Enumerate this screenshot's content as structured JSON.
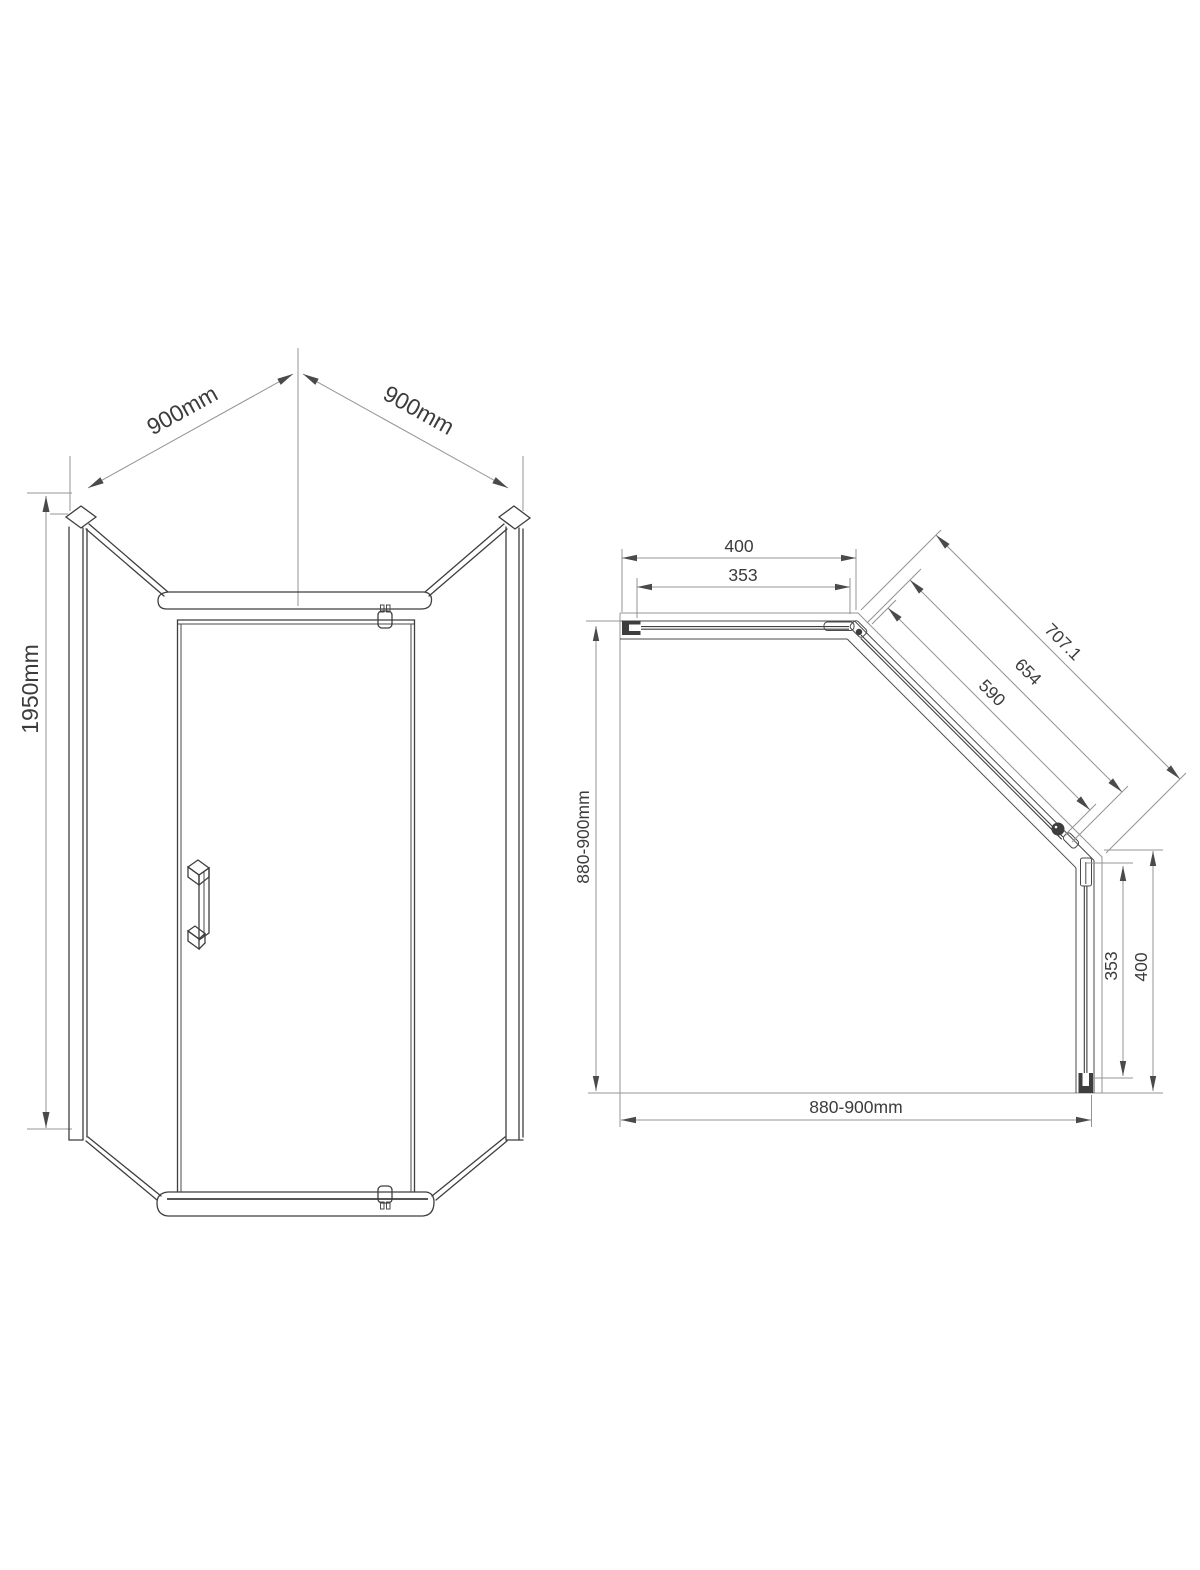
{
  "title": "Pentagonal shower enclosure technical drawing",
  "colors": {
    "background": "#ffffff",
    "line_dark": "#3e3e3e",
    "line_light": "#949494",
    "text": "#3c3c3c"
  },
  "dims": {
    "front": {
      "width_left": "900mm",
      "width_right": "900mm",
      "height": "1950mm"
    },
    "plan": {
      "top_outer": "400",
      "top_inner": "353",
      "diag_outer": "707.1",
      "diag_mid": "654",
      "diag_inner": "590",
      "right_inner": "353",
      "right_outer": "400",
      "bottom_span": "880-900mm",
      "left_span": "880-900mm"
    }
  }
}
